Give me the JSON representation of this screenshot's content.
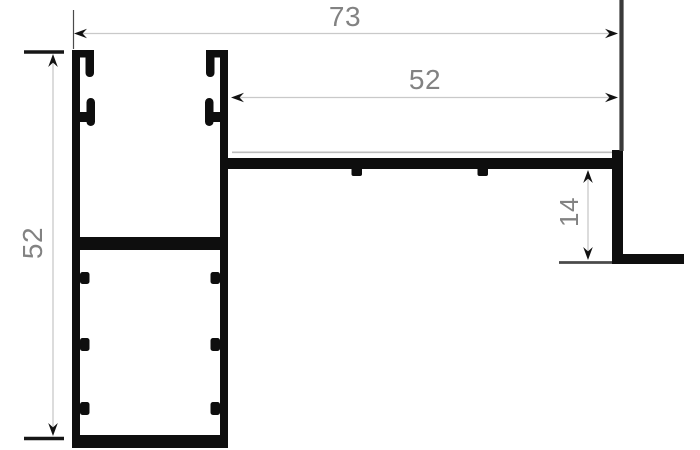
{
  "drawing": {
    "colors": {
      "profile": "#0e0e0e",
      "dim_line": "#c9c9c9",
      "dim_text": "#828282",
      "tick": "#161616",
      "extension_dark": "#3a3a3a",
      "extension_thin": "#4a4a4a",
      "step_line": "#bdbdbd",
      "datum_line": "#4a4a4a",
      "arrow": "#111111"
    },
    "dimensions": {
      "total_width": {
        "value": "73"
      },
      "arm_width": {
        "value": "52"
      },
      "left_height": {
        "value": "52"
      },
      "end_drop": {
        "value": "14"
      }
    }
  }
}
